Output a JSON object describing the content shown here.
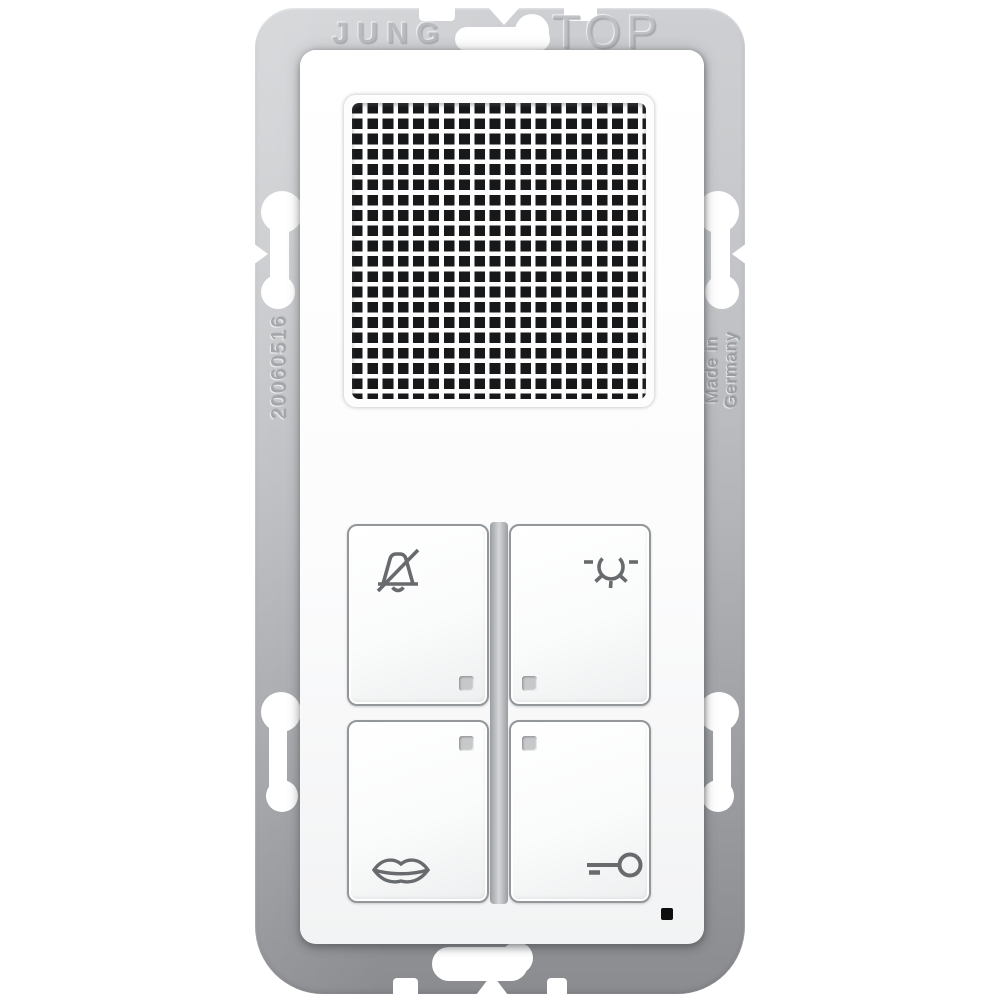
{
  "device": {
    "brand_marking": "JUNG",
    "orientation_marking": "TOP",
    "serial_marking": "20060516",
    "origin_marking": [
      "Made in",
      "Germany"
    ]
  },
  "buttons": [
    {
      "name": "bell-mute",
      "icon": "bell-muted-icon"
    },
    {
      "name": "light",
      "icon": "light-icon"
    },
    {
      "name": "speech",
      "icon": "lips-icon"
    },
    {
      "name": "door-open",
      "icon": "key-icon"
    }
  ],
  "indicators": {
    "led_count": 4,
    "microphone_hole": 1
  },
  "colors": {
    "plate_top": "#cdcfd2",
    "plate_bottom": "#8a8c90",
    "module": "#fbfbfc",
    "icon_stroke": "#686b6e",
    "grille_hole": "#17181a",
    "led": "#c6c8ca",
    "mic_hole": "#0e0e0f"
  }
}
